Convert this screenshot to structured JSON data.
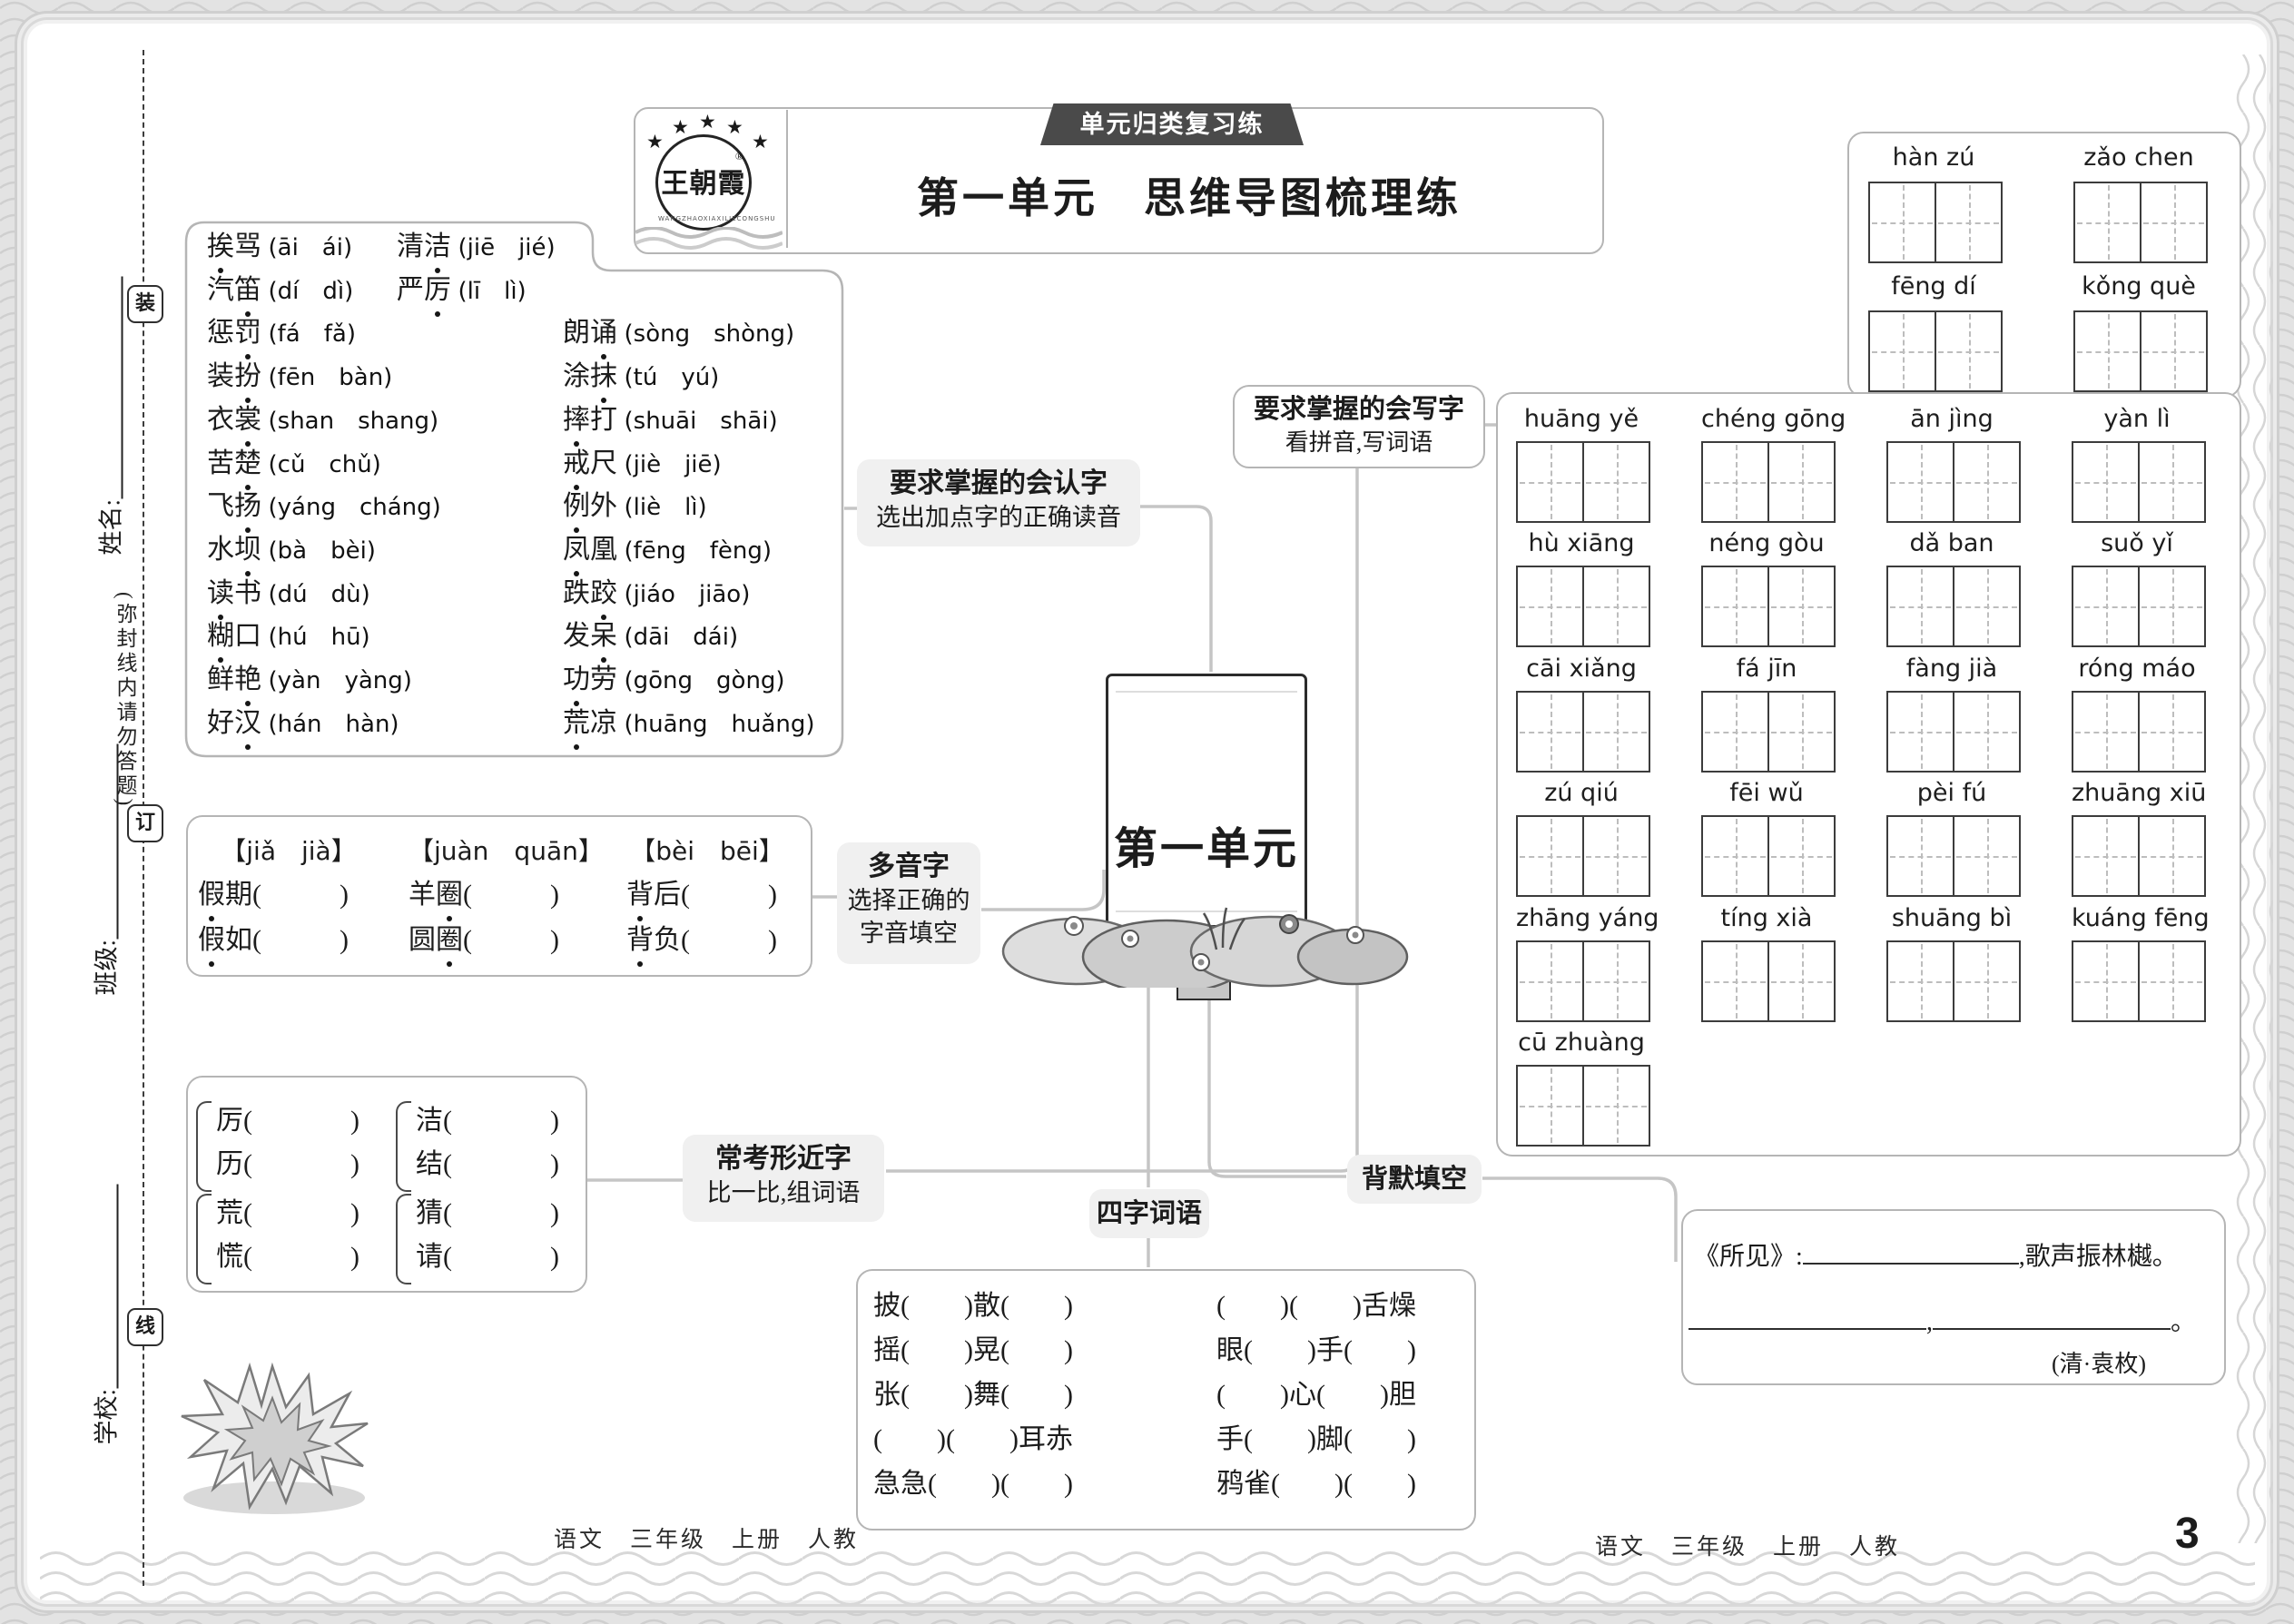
{
  "header": {
    "banner": "单元归类复习练",
    "title": "第一单元　思维导图梳理练",
    "brand": "王朝霞",
    "brand_reg": "®",
    "brand_ring": "WANGZHAOXIAXILIECONGSHU"
  },
  "sign": "第一单元",
  "nodes": {
    "renzi": {
      "title": "要求掌握的会认字",
      "subtitle": "选出加点字的正确读音"
    },
    "xiezi": {
      "title": "要求掌握的会写字",
      "subtitle": "看拼音,写词语"
    },
    "duoyinzi": {
      "title": "多音字",
      "subtitle1": "选择正确的",
      "subtitle2": "字音填空"
    },
    "xingjinzi": {
      "title": "常考形近字",
      "subtitle": "比一比,组词语"
    },
    "sizici": {
      "title": "四字词语"
    },
    "beimo": {
      "title": "背默填空"
    }
  },
  "renzi_words": {
    "left": [
      {
        "w": "挨骂",
        "d": 0,
        "p": "(āi　ái)"
      },
      {
        "w": "汽笛",
        "d": 1,
        "p": "(dí　dì)"
      },
      {
        "w": "惩罚",
        "d": 1,
        "p": "(fá　fǎ)"
      },
      {
        "w": "装扮",
        "d": 1,
        "p": "(fēn　bàn)"
      },
      {
        "w": "衣裳",
        "d": 1,
        "p": "(shan　shang)"
      },
      {
        "w": "苦楚",
        "d": 1,
        "p": "(cǔ　chǔ)"
      },
      {
        "w": "飞扬",
        "d": 1,
        "p": "(yáng　cháng)"
      },
      {
        "w": "水坝",
        "d": 1,
        "p": "(bà　bèi)"
      },
      {
        "w": "读书",
        "d": 0,
        "p": "(dú　dù)"
      },
      {
        "w": "糊口",
        "d": 0,
        "p": "(hú　hū)"
      },
      {
        "w": "鲜艳",
        "d": 1,
        "p": "(yàn　yàng)"
      },
      {
        "w": "好汉",
        "d": 1,
        "p": "(hán　hàn)"
      }
    ],
    "right": [
      {
        "w": "清洁",
        "d": 1,
        "p": "(jiē　jié)"
      },
      {
        "w": "严厉",
        "d": 1,
        "p": "(lī　lì)"
      },
      {
        "w": "朗诵",
        "d": 1,
        "p": "(sòng　shòng)"
      },
      {
        "w": "涂抹",
        "d": 1,
        "p": "(tú　yú)"
      },
      {
        "w": "摔打",
        "d": 0,
        "p": "(shuāi　shāi)"
      },
      {
        "w": "戒尺",
        "d": 0,
        "p": "(jiè　jiē)"
      },
      {
        "w": "例外",
        "d": 0,
        "p": "(liè　lì)"
      },
      {
        "w": "凤凰",
        "d": 0,
        "p": "(fēng　fèng)"
      },
      {
        "w": "跌跤",
        "d": 1,
        "p": "(jiáo　jiāo)"
      },
      {
        "w": "发呆",
        "d": 1,
        "p": "(dāi　dái)"
      },
      {
        "w": "功劳",
        "d": 0,
        "p": "(gōng　gòng)"
      },
      {
        "w": "荒凉",
        "d": 0,
        "p": "(huāng　huǎng)"
      }
    ]
  },
  "duoyinzi": {
    "groups": [
      {
        "head": "【jiǎ　jià】",
        "rows": [
          {
            "w": "假期",
            "d": 0
          },
          {
            "w": "假如",
            "d": 0
          }
        ]
      },
      {
        "head": "【juàn　quān】",
        "rows": [
          {
            "w": "羊圈",
            "d": 1
          },
          {
            "w": "圆圈",
            "d": 1
          }
        ]
      },
      {
        "head": "【bèi　bēi】",
        "rows": [
          {
            "w": "背后",
            "d": 0
          },
          {
            "w": "背负",
            "d": 0
          }
        ]
      }
    ]
  },
  "xingjinzi": {
    "pairs": [
      [
        "厉",
        "历"
      ],
      [
        "荒",
        "慌"
      ],
      [
        "洁",
        "结"
      ],
      [
        "猜",
        "请"
      ]
    ]
  },
  "xiezi_grids": {
    "top_rows": [
      [
        "hàn zú",
        "zǎo chen"
      ],
      [
        "fēng dí",
        "kǒng què"
      ]
    ],
    "main_rows": [
      [
        "huāng yě",
        "chéng gōng",
        "ān jìng",
        "yàn lì"
      ],
      [
        "hù xiāng",
        "néng gòu",
        "dǎ ban",
        "suǒ yǐ"
      ],
      [
        "cāi xiǎng",
        "fá jīn",
        "fàng jià",
        "róng máo"
      ],
      [
        "zú qiú",
        "fēi wǔ",
        "pèi fú",
        "zhuāng xiū"
      ],
      [
        "zhāng yáng",
        "tíng xià",
        "shuāng bì",
        "kuáng fēng"
      ],
      [
        "cū zhuàng"
      ]
    ]
  },
  "sizici": {
    "left": [
      "披(　　)散(　　)",
      "摇(　　)晃(　　)",
      "张(　　)舞(　　)",
      "(　　)(　　)耳赤",
      "急急(　　)(　　)"
    ],
    "right": [
      "(　　)(　　)舌燥",
      "眼(　　)手(　　)",
      "(　　)心(　　)胆",
      "手(　　)脚(　　)",
      "鸦雀(　　)(　　)"
    ]
  },
  "beimo_content": {
    "lead": "《所见》:",
    "tail1": ",歌声振林樾。",
    "comma": ",",
    "period": "。",
    "author": "(清·袁枚)"
  },
  "sidebar": {
    "fields": [
      "姓名:",
      "班级:",
      "学校:"
    ],
    "note": "(弥封线内请勿答题)",
    "binding_marks": [
      "装",
      "订",
      "线"
    ]
  },
  "footer": {
    "left": "语文　三年级　上册　人教",
    "right": "语文　三年级　上册　人教",
    "page": "3"
  },
  "colors": {
    "banner_bg": "#4a4a4a",
    "label_bg": "#f0f0f0",
    "box_border": "#b5b5b5",
    "connector": "#c5c5c5"
  }
}
